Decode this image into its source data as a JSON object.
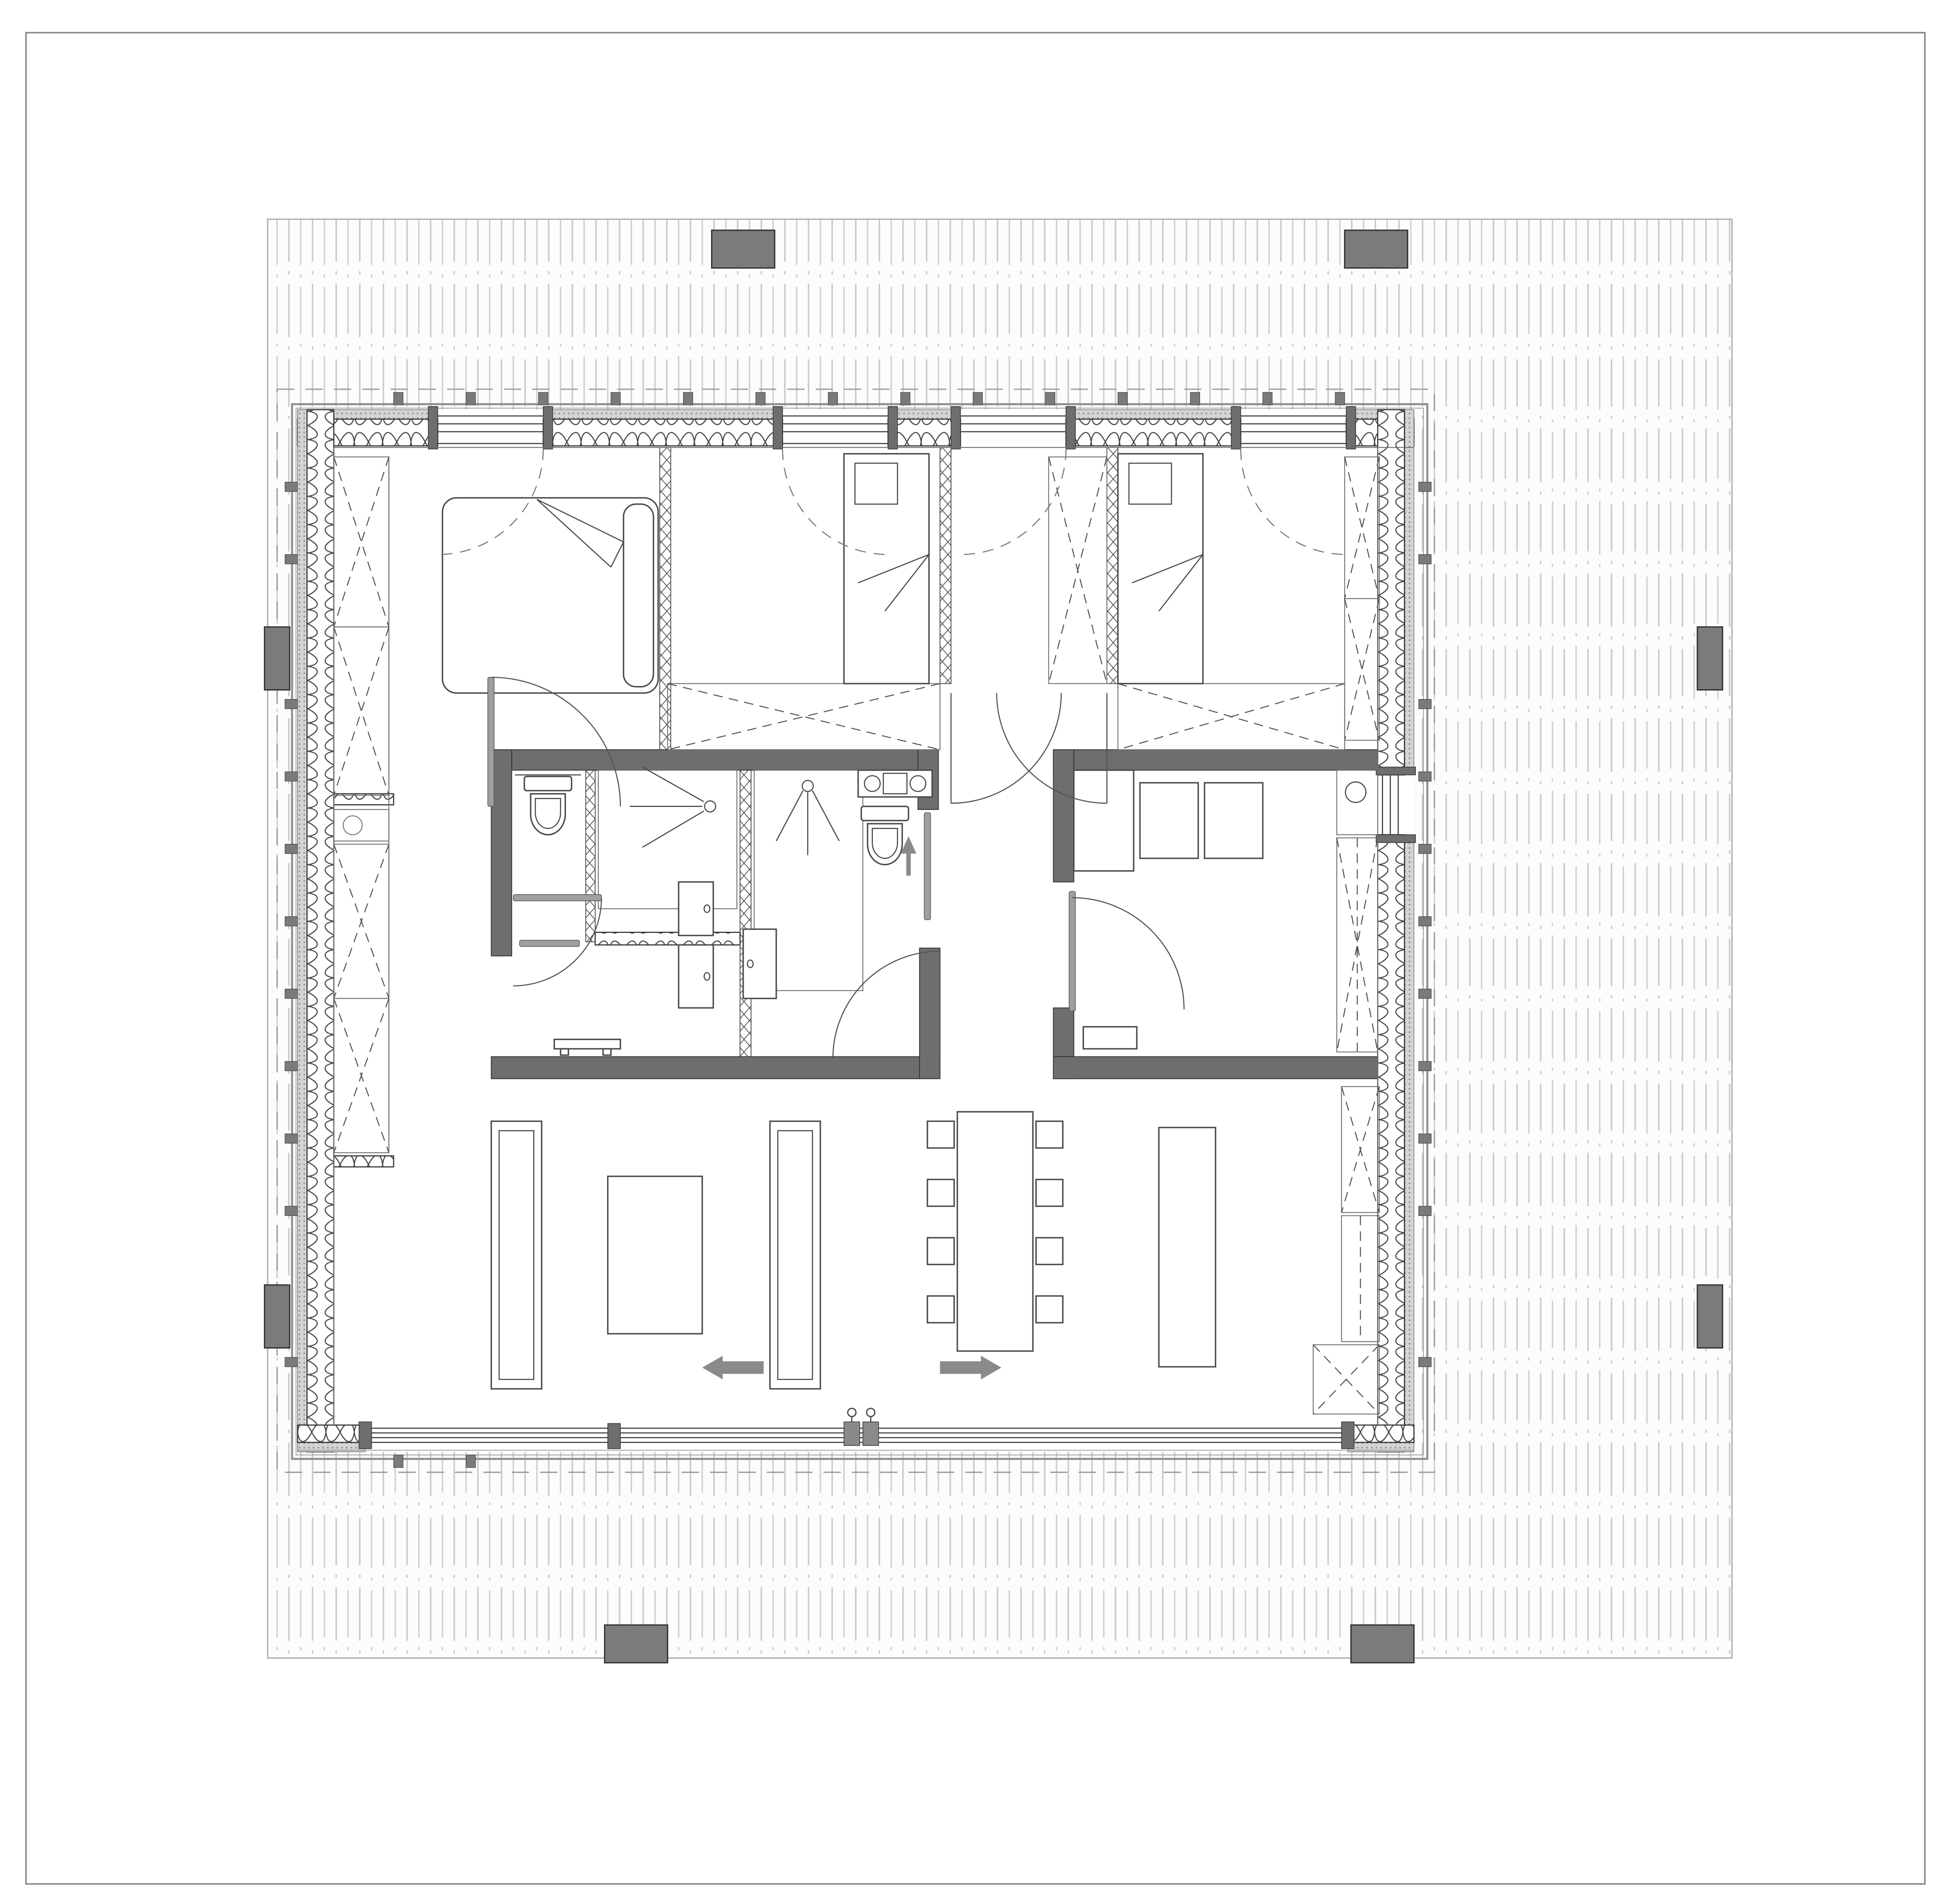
{
  "drawing": {
    "kind": "architectural floor plan",
    "visible_text": []
  },
  "colors": {
    "page_background": "#ffffff",
    "frame_line": "#8c8c8c",
    "deck_fill": "#fcfcfc",
    "deck_stripe": "#c7c7c7",
    "deck_edge": "#aaaaaa",
    "core_wall": "#6e6e6e",
    "post": "#7b7b7b",
    "tab": "#7a7a7a",
    "stucco_band": "#cccccc",
    "insulation_line": "#4a4a4a",
    "door_leaf": "#9f9f9f",
    "glyph_gray": "#8a8a8a",
    "drawing_line": "#3c3c3c"
  },
  "glyphs": {
    "slide_arrows": [
      "arrow-left",
      "arrow-right"
    ],
    "door_handles": 2,
    "shower_heads": 2,
    "toilets": 2,
    "basins": 3
  },
  "layout": {
    "posts": [
      [
        452,
        146,
        40,
        24
      ],
      [
        854,
        146,
        40,
        24
      ],
      [
        384,
        1032,
        40,
        24
      ],
      [
        858,
        1032,
        40,
        24
      ],
      [
        168,
        398,
        16,
        40
      ],
      [
        168,
        816,
        16,
        40
      ],
      [
        1078,
        398,
        16,
        40
      ],
      [
        1078,
        816,
        16,
        40
      ]
    ],
    "tabs": [
      [
        250,
        249,
        6,
        8
      ],
      [
        296,
        249,
        6,
        8
      ],
      [
        342,
        249,
        6,
        8
      ],
      [
        388,
        249,
        6,
        8
      ],
      [
        434,
        249,
        6,
        8
      ],
      [
        480,
        249,
        6,
        8
      ],
      [
        526,
        249,
        6,
        8
      ],
      [
        572,
        249,
        6,
        8
      ],
      [
        618,
        249,
        6,
        8
      ],
      [
        664,
        249,
        6,
        8
      ],
      [
        710,
        249,
        6,
        8
      ],
      [
        756,
        249,
        6,
        8
      ],
      [
        802,
        249,
        6,
        8
      ],
      [
        848,
        249,
        6,
        8
      ],
      [
        181,
        306,
        8,
        6
      ],
      [
        181,
        352,
        8,
        6
      ],
      [
        181,
        444,
        8,
        6
      ],
      [
        181,
        490,
        8,
        6
      ],
      [
        181,
        536,
        8,
        6
      ],
      [
        181,
        582,
        8,
        6
      ],
      [
        181,
        628,
        8,
        6
      ],
      [
        181,
        674,
        8,
        6
      ],
      [
        181,
        720,
        8,
        6
      ],
      [
        181,
        766,
        8,
        6
      ],
      [
        181,
        862,
        8,
        6
      ],
      [
        901,
        306,
        8,
        6
      ],
      [
        901,
        352,
        8,
        6
      ],
      [
        901,
        444,
        8,
        6
      ],
      [
        901,
        490,
        8,
        6
      ],
      [
        901,
        536,
        8,
        6
      ],
      [
        901,
        582,
        8,
        6
      ],
      [
        901,
        628,
        8,
        6
      ],
      [
        901,
        674,
        8,
        6
      ],
      [
        901,
        720,
        8,
        6
      ],
      [
        901,
        766,
        8,
        6
      ],
      [
        901,
        862,
        8,
        6
      ],
      [
        250,
        924,
        6,
        8
      ],
      [
        296,
        924,
        6,
        8
      ]
    ],
    "wardrobe_x_boxes": [
      [
        212,
        290,
        35,
        108
      ],
      [
        212,
        398,
        35,
        107
      ],
      [
        212,
        536,
        35,
        98
      ],
      [
        212,
        634,
        35,
        98
      ],
      [
        854,
        290,
        22,
        90
      ],
      [
        854,
        380,
        22,
        90
      ],
      [
        666,
        290,
        37,
        144
      ],
      [
        424,
        434,
        173,
        42
      ],
      [
        710,
        434,
        144,
        42
      ],
      [
        849,
        532,
        26,
        136
      ],
      [
        852,
        690,
        24,
        80
      ],
      [
        834,
        854,
        42,
        44
      ]
    ],
    "chairs": [
      [
        589,
        712
      ],
      [
        589,
        749
      ],
      [
        589,
        786
      ],
      [
        589,
        823
      ],
      [
        658,
        712
      ],
      [
        658,
        749
      ],
      [
        658,
        786
      ],
      [
        658,
        823
      ]
    ],
    "chair_size": 17
  }
}
